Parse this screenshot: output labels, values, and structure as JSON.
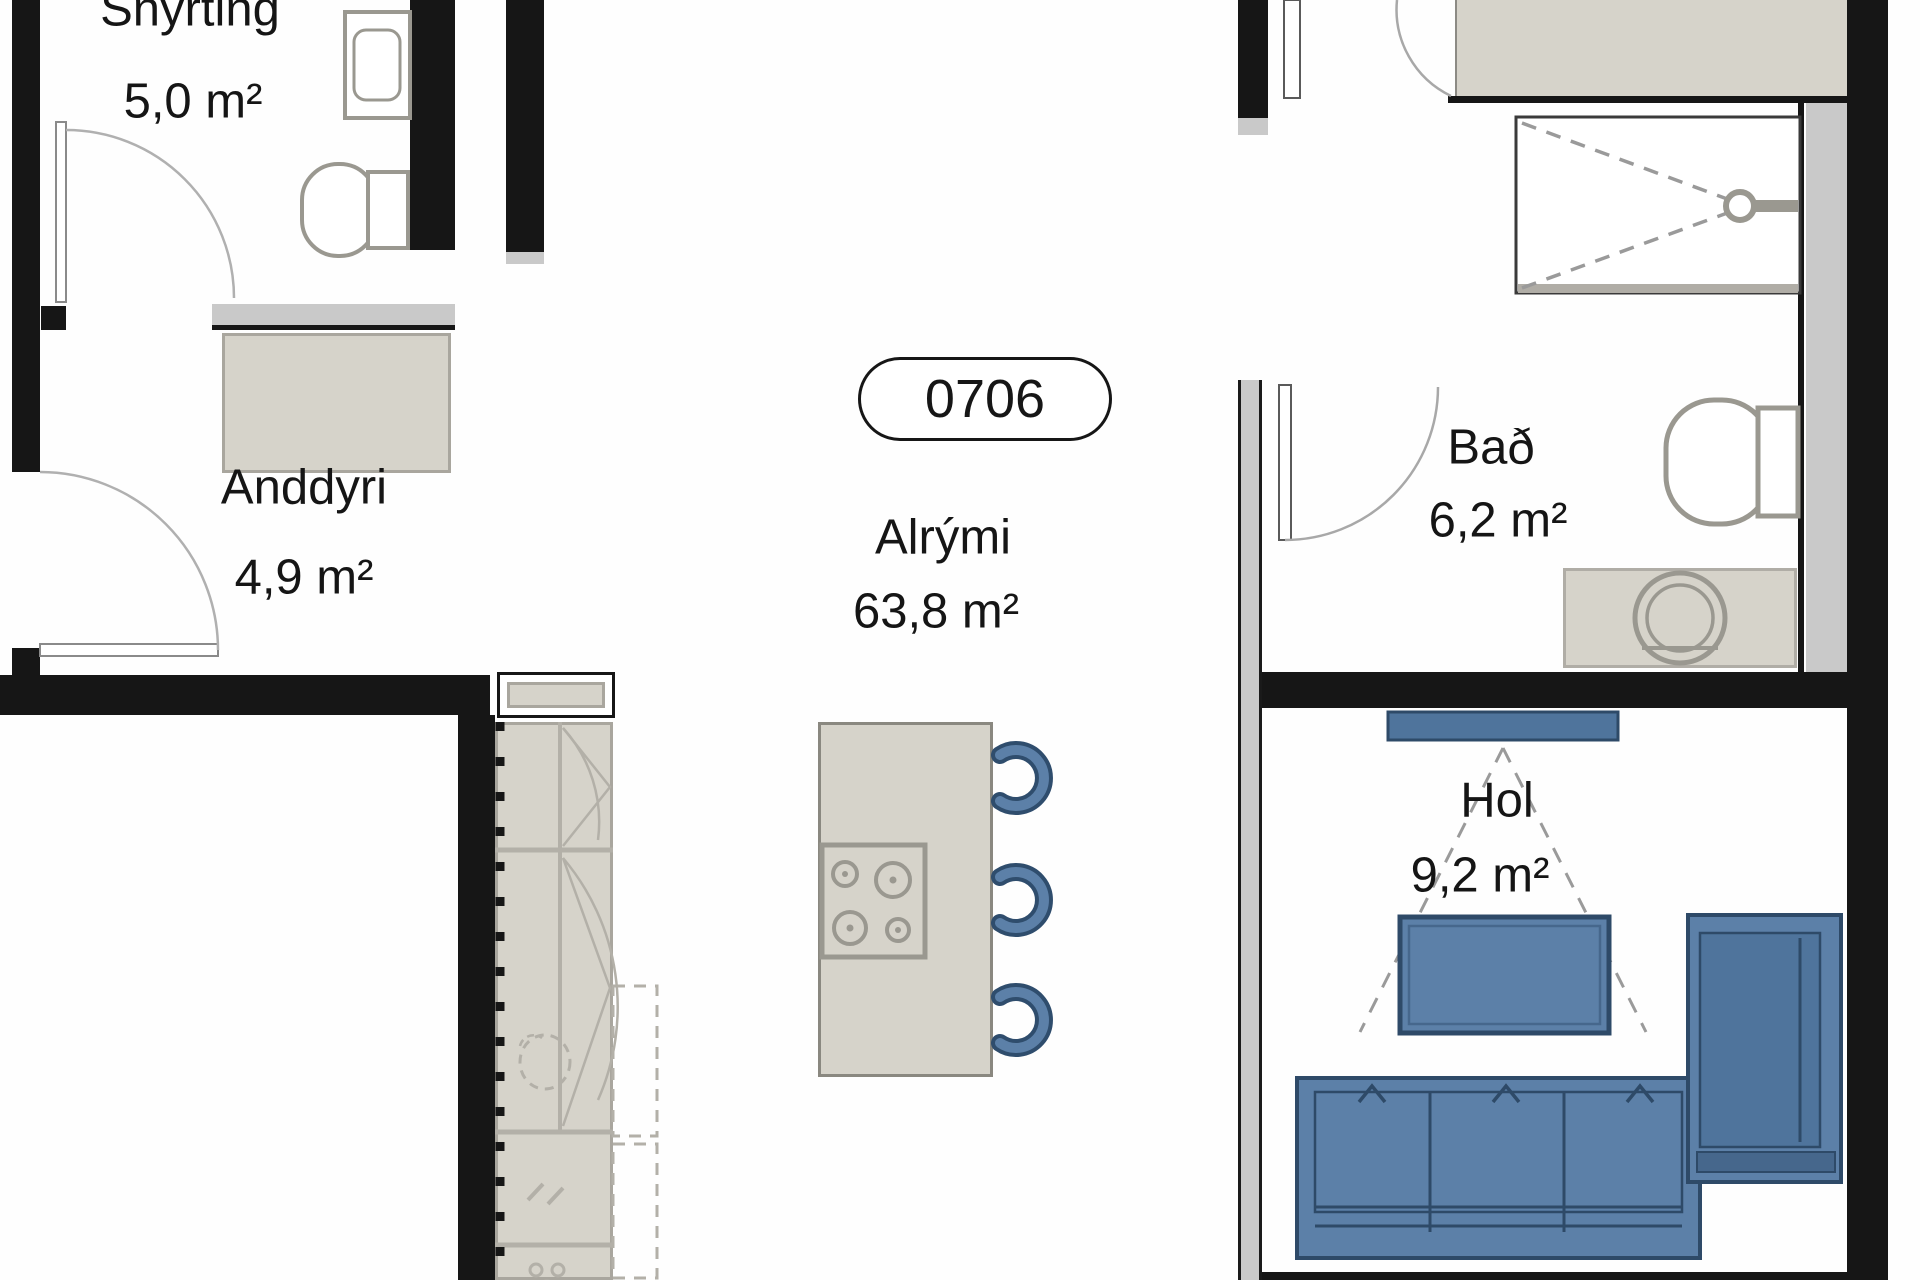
{
  "unit": {
    "number": "0706"
  },
  "rooms": {
    "snyrting": {
      "name": "Snyrting",
      "area": "5,0 m²"
    },
    "anddyri": {
      "name": "Anddyri",
      "area": "4,9 m²"
    },
    "alrymi": {
      "name": "Alrými",
      "area": "63,8 m²"
    },
    "bad": {
      "name": "Bað",
      "area": "6,2 m²"
    },
    "hol": {
      "name": "Hol",
      "area": "9,2 m²"
    }
  },
  "colors": {
    "wall": "#161616",
    "partition": "#c9c9c9",
    "fixture_fill": "#d6d3ca",
    "fixture_border": "#a9a69e",
    "furniture_fill": "#5c80a8",
    "furniture_border": "#2e4a68",
    "background": "#ffffff"
  },
  "fixtures": {
    "snyrting": [
      "wash-basin",
      "toilet",
      "door-swing"
    ],
    "anddyri": [
      "wardrobe",
      "entrance-door-swing"
    ],
    "kitchen": [
      "counter-window",
      "cabinet-run",
      "dashed-upper-cabinets",
      "sink-dashed",
      "oven",
      "fan",
      "island",
      "cooktop",
      "bar-stools"
    ],
    "bad": [
      "shower",
      "shower-head",
      "toilet",
      "washing-machine",
      "door-swing"
    ],
    "hol": [
      "tv",
      "tv-viewing-cone",
      "table",
      "sofa",
      "armchair"
    ],
    "top_right": [
      "closet",
      "door-swing"
    ]
  }
}
